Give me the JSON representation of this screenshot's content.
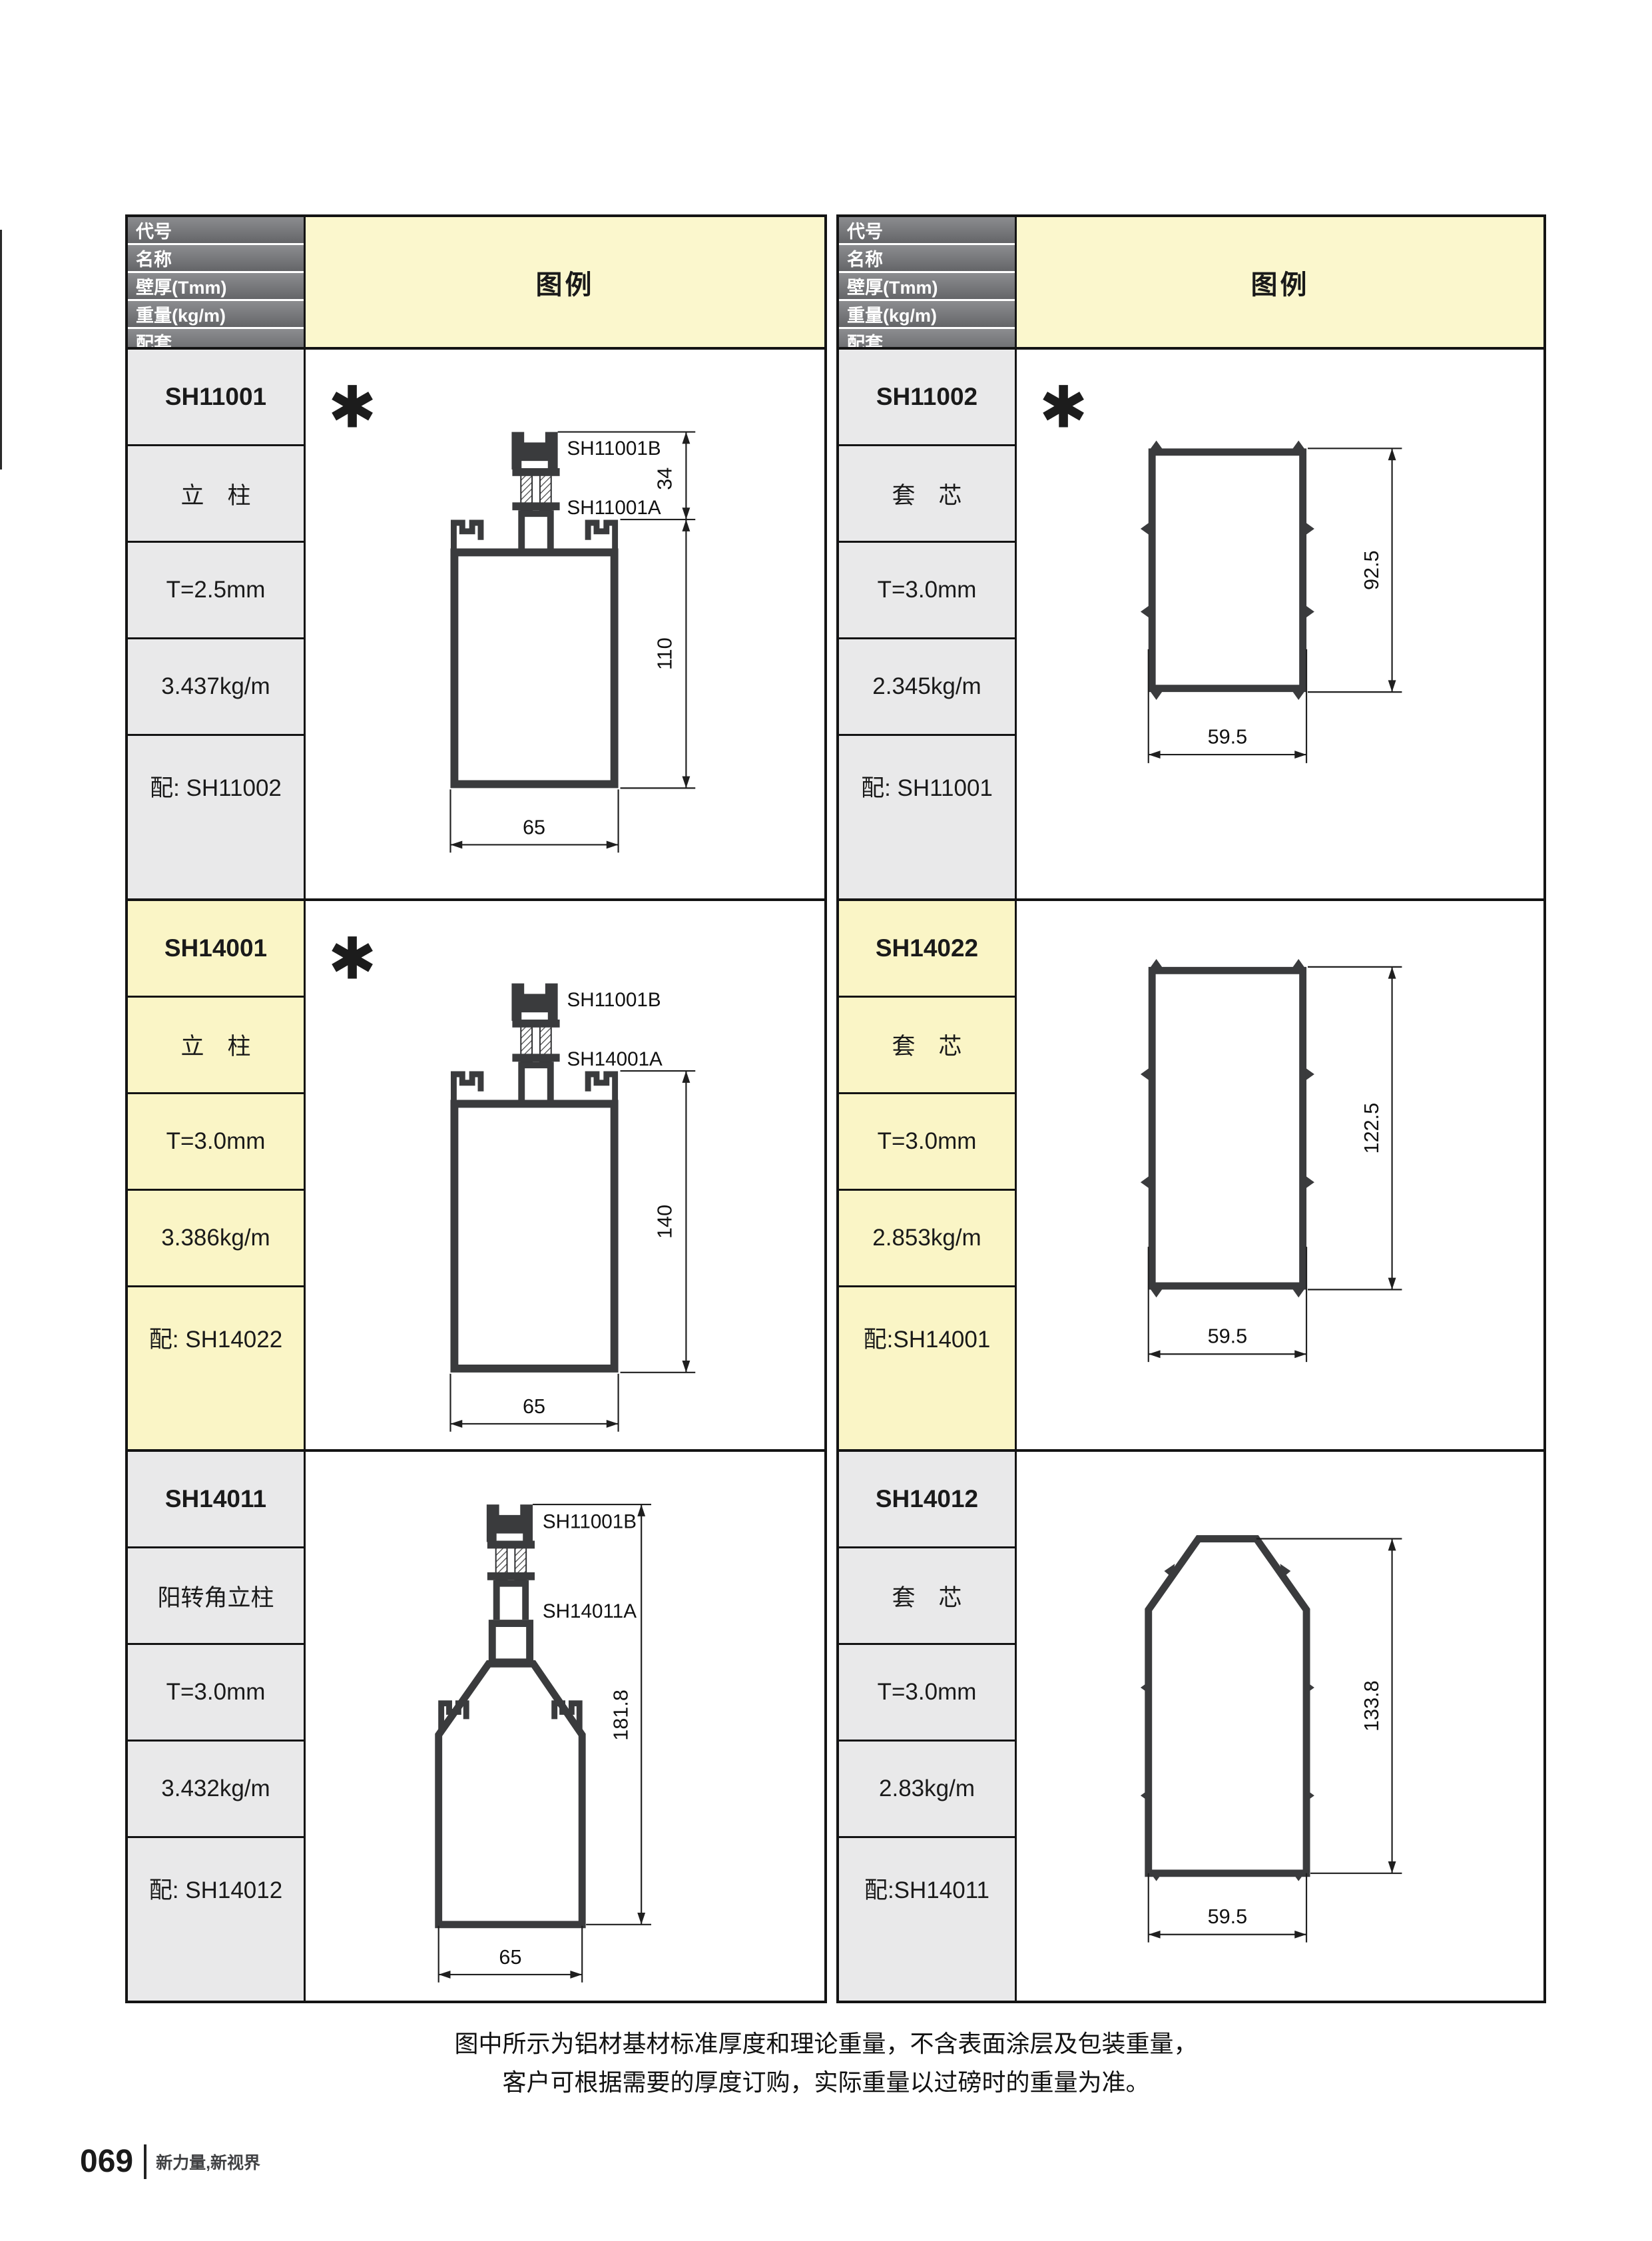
{
  "page": {
    "note_line1": "图中所示为铝材基材标准厚度和理论重量，不含表面涂层及包装重量，",
    "note_line2": "客户可根据需要的厚度订购，实际重量以过磅时的重量为准。",
    "footer_page_number": "069",
    "footer_slogan": "新力量,新视界"
  },
  "header": {
    "row_labels": [
      "代号",
      "名称",
      "壁厚(Tmm)",
      "重量(kg/m)",
      "配套"
    ],
    "legend_label": "图例"
  },
  "colors": {
    "header_gray": "#77787b",
    "legend_yellow": "#fbf7cd",
    "row_gray": "#e9e9ea",
    "row_yellow": "#faf5c6",
    "profile_dark": "#3a3b3d"
  },
  "products": [
    {
      "code": "SH11001",
      "name": "立　柱",
      "thickness": "T=2.5mm",
      "weight": "3.437kg/m",
      "match": "配: SH11002",
      "asterisk": "✱",
      "diagram": {
        "label_b": "SH11001B",
        "label_a": "SH11001A",
        "dim_top": "34",
        "dim_height": "110",
        "dim_width": "65"
      }
    },
    {
      "code": "SH11002",
      "name": "套　芯",
      "thickness": "T=3.0mm",
      "weight": "2.345kg/m",
      "match": "配: SH11001",
      "asterisk": "✱",
      "diagram": {
        "dim_height": "92.5",
        "dim_width": "59.5"
      }
    },
    {
      "code": "SH14001",
      "name": "立　柱",
      "thickness": "T=3.0mm",
      "weight": "3.386kg/m",
      "match": "配: SH14022",
      "asterisk": "✱",
      "diagram": {
        "label_b": "SH11001B",
        "label_a": "SH14001A",
        "dim_height": "140",
        "dim_width": "65"
      }
    },
    {
      "code": "SH14022",
      "name": "套　芯",
      "thickness": "T=3.0mm",
      "weight": "2.853kg/m",
      "match": "配:SH14001",
      "asterisk": "",
      "diagram": {
        "dim_height": "122.5",
        "dim_width": "59.5"
      }
    },
    {
      "code": "SH14011",
      "name": "阳转角立柱",
      "thickness": "T=3.0mm",
      "weight": "3.432kg/m",
      "match": "配: SH14012",
      "asterisk": "",
      "diagram": {
        "label_b": "SH11001B",
        "label_a": "SH14011A",
        "dim_height": "181.8",
        "dim_width": "65"
      }
    },
    {
      "code": "SH14012",
      "name": "套　芯",
      "thickness": "T=3.0mm",
      "weight": "2.83kg/m",
      "match": "配:SH14011",
      "asterisk": "",
      "diagram": {
        "dim_height": "133.8",
        "dim_width": "59.5"
      }
    }
  ]
}
